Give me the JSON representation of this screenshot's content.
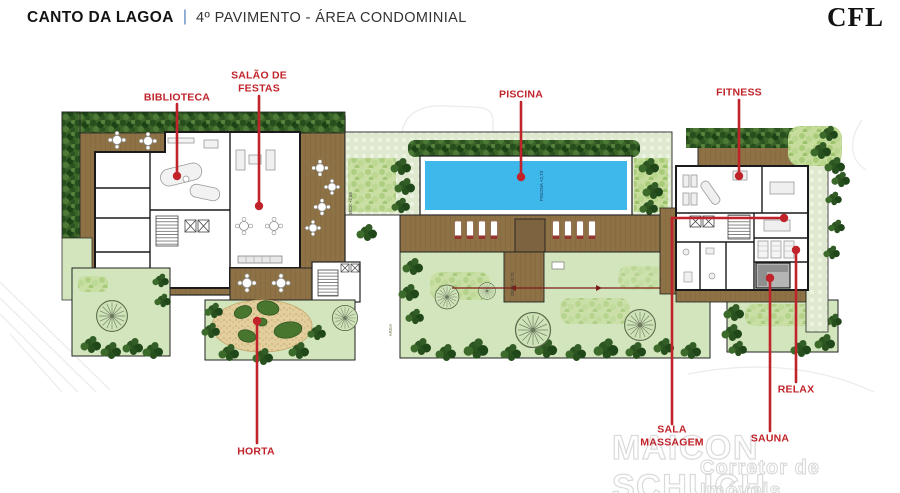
{
  "header": {
    "project": "CANTO DA LAGOA",
    "separator": "|",
    "subtitle": "4º PAVIMENTO - ÁREA CONDOMINIAL",
    "logo": "CFL"
  },
  "labels": {
    "biblioteca": "BIBLIOTECA",
    "salao_line1": "SALÃO DE",
    "salao_line2": "FESTAS",
    "piscina": "PISCINA",
    "fitness": "FITNESS",
    "horta": "HORTA",
    "massagem_line1": "SALA",
    "massagem_line2": "MASSAGEM",
    "sauna": "SAUNA",
    "relax": "RELAX"
  },
  "plan_texts": {
    "pool_level": "PISCINA +2,73",
    "deck_level": "DECK +2,70",
    "deck_level_2": "DECK +2,68",
    "sand": "AREIA"
  },
  "watermark": {
    "name": "MAICON SCHUCH",
    "tagline": "Corretor de Imóveis"
  },
  "colors": {
    "annotation_red": "#c0232a",
    "pool_blue": "#3eb7ea",
    "deck_brown": "#8e7246",
    "lawn_green": "#d3e5bd",
    "hedge_green": "#2c5522",
    "separator_blue": "#5b86c2"
  }
}
